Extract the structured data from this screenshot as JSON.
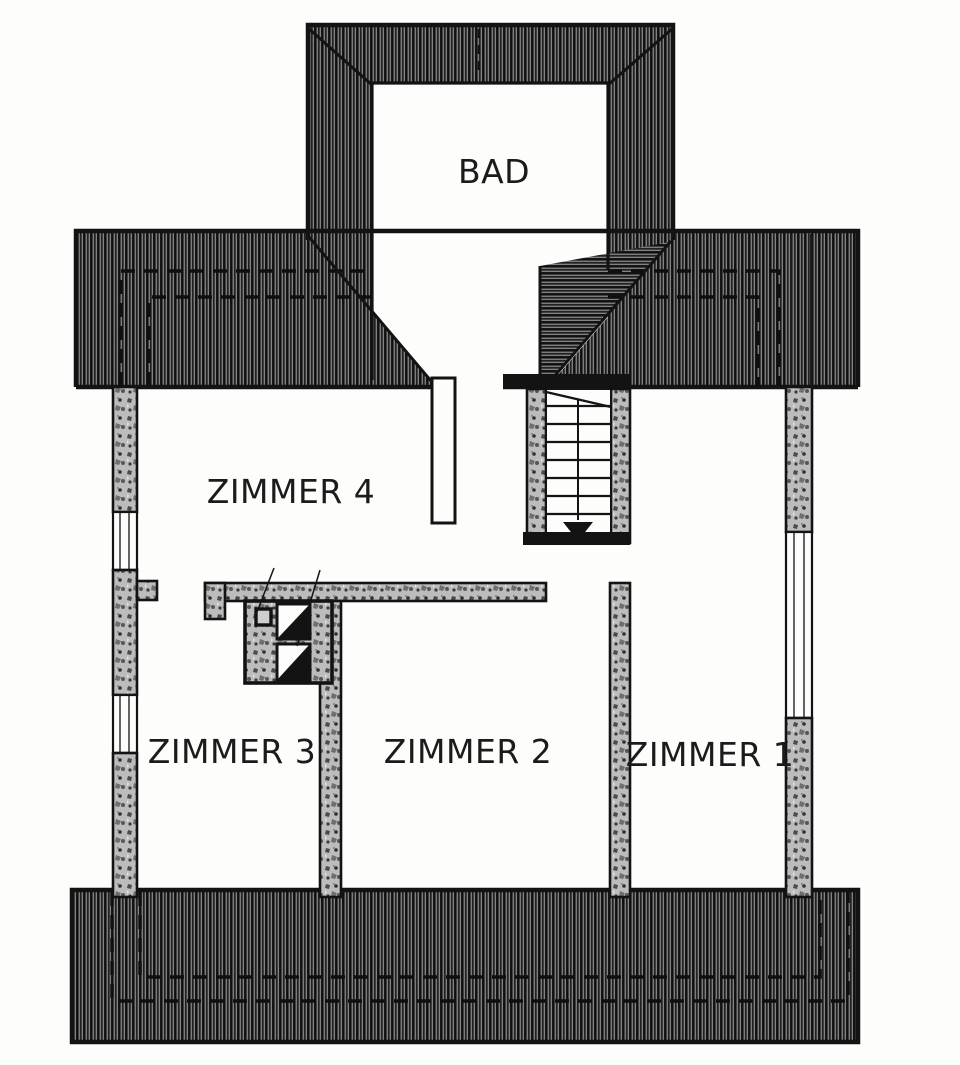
{
  "plan": {
    "type": "architectural-floor-plan",
    "rooms": {
      "bad": {
        "label": "BAD"
      },
      "zimmer4": {
        "label": "ZIMMER 4"
      },
      "zimmer3": {
        "label": "ZIMMER 3"
      },
      "zimmer2": {
        "label": "ZIMMER 2"
      },
      "zimmer1": {
        "label": "ZIMMER 1"
      }
    },
    "stair": {
      "direction_marker": "down-arrow",
      "treads": 8
    },
    "chimney": {
      "flues": 2
    },
    "colors": {
      "ink": "#161616",
      "paper": "#fdfdfc",
      "roof_hatch_dark": "#4d4d4d",
      "wall_fill": "#bcbcbc"
    }
  }
}
